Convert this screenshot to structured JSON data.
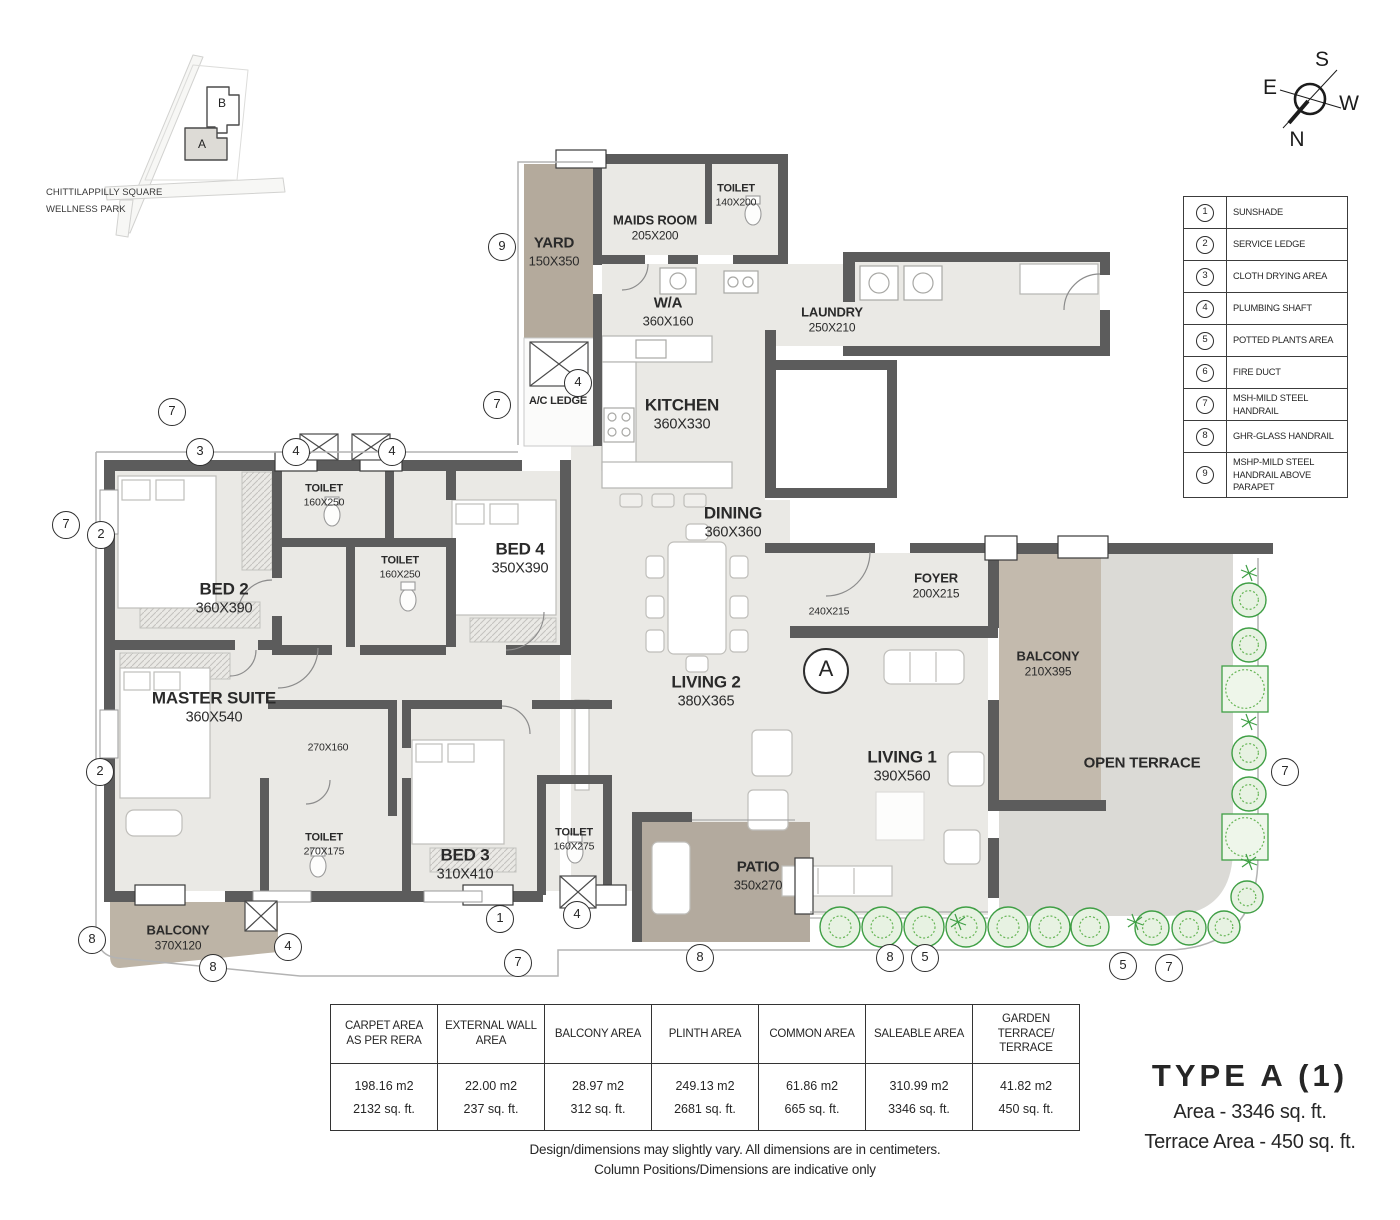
{
  "site_map": {
    "line1": "CHITTILAPPILLY SQUARE",
    "line2": "WELLNESS PARK",
    "building_a": "A",
    "building_b": "B"
  },
  "compass": {
    "n": "N",
    "s": "S",
    "e": "E",
    "w": "W"
  },
  "legend": {
    "items": [
      {
        "num": "1",
        "label": "SUNSHADE"
      },
      {
        "num": "2",
        "label": "SERVICE LEDGE"
      },
      {
        "num": "3",
        "label": "CLOTH DRYING AREA"
      },
      {
        "num": "4",
        "label": "PLUMBING SHAFT"
      },
      {
        "num": "5",
        "label": "POTTED PLANTS AREA"
      },
      {
        "num": "6",
        "label": "FIRE DUCT"
      },
      {
        "num": "7",
        "label": "MSH-MILD STEEL HANDRAIL"
      },
      {
        "num": "8",
        "label": "GHR-GLASS HANDRAIL"
      },
      {
        "num": "9",
        "label": "MSHP-MILD STEEL HANDRAIL ABOVE PARAPET"
      }
    ]
  },
  "rooms": {
    "yard": {
      "name": "YARD",
      "dims": "150X350"
    },
    "maids_room": {
      "name": "MAIDS ROOM",
      "dims": "205X200"
    },
    "toilet_maids": {
      "name": "TOILET",
      "dims": "140X200"
    },
    "work_area": {
      "name": "W/A",
      "dims": "360X160"
    },
    "laundry": {
      "name": "LAUNDRY",
      "dims": "250X210"
    },
    "kitchen": {
      "name": "KITCHEN",
      "dims": "360X330"
    },
    "ac_ledge": {
      "name": "A/C LEDGE"
    },
    "dining": {
      "name": "DINING",
      "dims": "360X360"
    },
    "foyer": {
      "name": "FOYER",
      "dims": "200X215"
    },
    "passage": {
      "dims": "240X215"
    },
    "living2": {
      "name": "LIVING 2",
      "dims": "380X365"
    },
    "living1": {
      "name": "LIVING 1",
      "dims": "390X560"
    },
    "balcony_right": {
      "name": "BALCONY",
      "dims": "210X395"
    },
    "open_terrace": {
      "name": "OPEN TERRACE"
    },
    "bed2": {
      "name": "BED 2",
      "dims": "360X390"
    },
    "toilet_bed2": {
      "name": "TOILET",
      "dims": "160X250"
    },
    "toilet_mid": {
      "name": "TOILET",
      "dims": "160X250"
    },
    "bed4": {
      "name": "BED 4",
      "dims": "350X390"
    },
    "master_suite": {
      "name": "MASTER SUITE",
      "dims": "360X540"
    },
    "dressing": {
      "dims": "270X160"
    },
    "toilet_master": {
      "name": "TOILET",
      "dims": "270X175"
    },
    "bed3": {
      "name": "BED 3",
      "dims": "310X410"
    },
    "toilet_bed3": {
      "name": "TOILET",
      "dims": "160X275"
    },
    "patio": {
      "name": "PATIO",
      "dims": "350x270"
    },
    "balcony_left": {
      "name": "BALCONY",
      "dims": "370X120"
    }
  },
  "unit_marker": "A",
  "markers": [
    {
      "n": "9",
      "x": 502,
      "y": 247
    },
    {
      "n": "4",
      "x": 578,
      "y": 383
    },
    {
      "n": "7",
      "x": 497,
      "y": 405
    },
    {
      "n": "7",
      "x": 172,
      "y": 412
    },
    {
      "n": "3",
      "x": 200,
      "y": 452
    },
    {
      "n": "4",
      "x": 296,
      "y": 452
    },
    {
      "n": "4",
      "x": 392,
      "y": 452
    },
    {
      "n": "7",
      "x": 66,
      "y": 525
    },
    {
      "n": "2",
      "x": 101,
      "y": 535
    },
    {
      "n": "2",
      "x": 100,
      "y": 772
    },
    {
      "n": "8",
      "x": 92,
      "y": 940
    },
    {
      "n": "8",
      "x": 213,
      "y": 968
    },
    {
      "n": "4",
      "x": 288,
      "y": 947
    },
    {
      "n": "1",
      "x": 500,
      "y": 919
    },
    {
      "n": "4",
      "x": 577,
      "y": 915
    },
    {
      "n": "7",
      "x": 518,
      "y": 963
    },
    {
      "n": "8",
      "x": 700,
      "y": 958
    },
    {
      "n": "8",
      "x": 890,
      "y": 958
    },
    {
      "n": "5",
      "x": 925,
      "y": 958
    },
    {
      "n": "5",
      "x": 1123,
      "y": 966
    },
    {
      "n": "7",
      "x": 1169,
      "y": 968
    },
    {
      "n": "7",
      "x": 1285,
      "y": 772
    }
  ],
  "area_table": {
    "columns": [
      {
        "header": "CARPET AREA AS PER RERA",
        "m2": "198.16 m2",
        "sqft": "2132 sq. ft."
      },
      {
        "header": "EXTERNAL WALL AREA",
        "m2": "22.00 m2",
        "sqft": "237 sq. ft."
      },
      {
        "header": "BALCONY AREA",
        "m2": "28.97 m2",
        "sqft": "312 sq. ft."
      },
      {
        "header": "PLINTH AREA",
        "m2": "249.13 m2",
        "sqft": "2681 sq. ft."
      },
      {
        "header": "COMMON AREA",
        "m2": "61.86 m2",
        "sqft": "665 sq. ft."
      },
      {
        "header": "SALEABLE AREA",
        "m2": "310.99 m2",
        "sqft": "3346 sq. ft."
      },
      {
        "header": "GARDEN TERRACE/ TERRACE",
        "m2": "41.82 m2",
        "sqft": "450 sq. ft."
      }
    ]
  },
  "title_block": {
    "title": "TYPE A (1)",
    "area_line": "Area - 3346 sq. ft.",
    "terrace_line": "Terrace Area - 450 sq. ft."
  },
  "disclaimer": {
    "line1": "Design/dimensions may slightly vary. All dimensions are in centimeters.",
    "line2": "Column Positions/Dimensions are indicative only"
  },
  "colors": {
    "wall": "#5c5c5c",
    "outdoor": "#b7aea1",
    "terrace": "#dbdad6",
    "plants": "#3f9f45"
  }
}
